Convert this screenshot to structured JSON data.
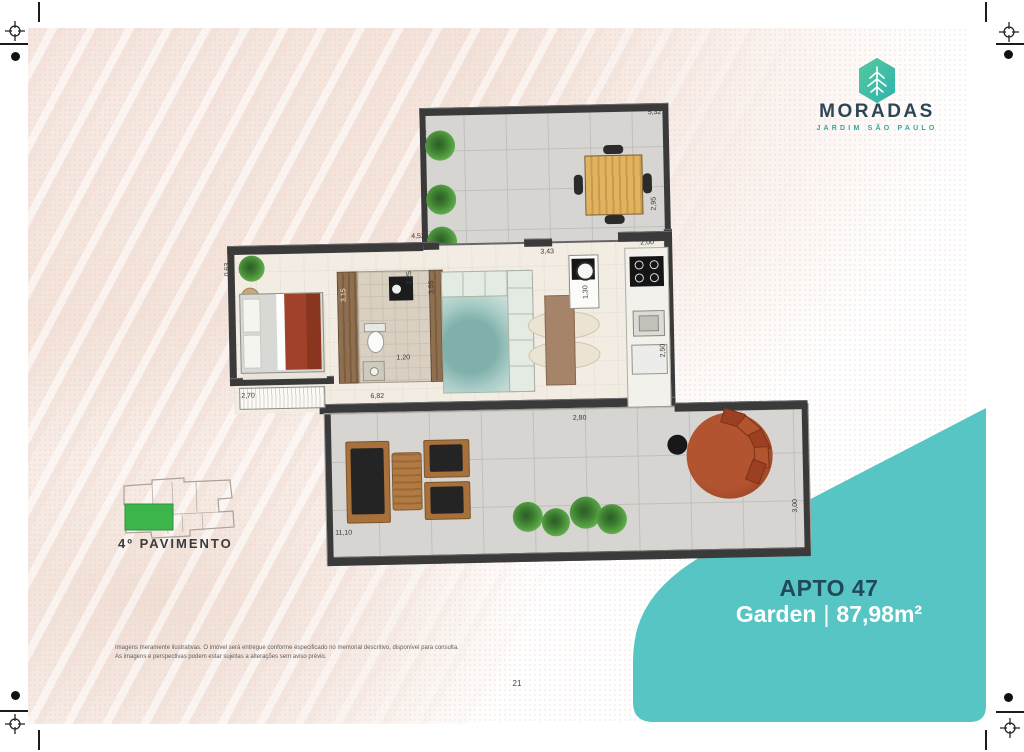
{
  "brand": {
    "name": "MORADAS",
    "subtitle": "JARDIM SÃO PAULO"
  },
  "unit_card": {
    "unit": "APTO 47",
    "type": "Garden",
    "separator": "|",
    "area": "87,98m²"
  },
  "floor_key": {
    "label": "4º PAVIMENTO"
  },
  "plan": {
    "dims": {
      "terrace_top": "5,32",
      "terrace_left": "2,49",
      "terrace_right": "2,95",
      "upper_opening": "4,52",
      "entry_niche": "0,63",
      "bedroom_wall": "3,15",
      "bath_top": "2,25",
      "bath_bottom": "1,20",
      "bath_living_wall": "3,55",
      "wardrobe": "2,70",
      "living_top": "3,43",
      "counter": "1,30",
      "kitchen_top": "2,00",
      "kitchen_bottom": "2,50",
      "living_garden_wall": "6,82",
      "garden_top": "2,80",
      "garden_width": "11,10",
      "garden_right": "3,00"
    }
  },
  "footer": {
    "page_number": "21",
    "disclaimer_line1": "Imagens meramente ilustrativas. O imóvel será entregue conforme especificado no memorial descritivo, disponível para consulta.",
    "disclaimer_line2": "As imagens e perspectivas podem estar sujeitas a alterações sem aviso prévio."
  },
  "colors": {
    "accent": "#58c5c5",
    "navy": "#27495a",
    "logo_green": "#3fc0a0",
    "key_green": "#3cb54a"
  }
}
